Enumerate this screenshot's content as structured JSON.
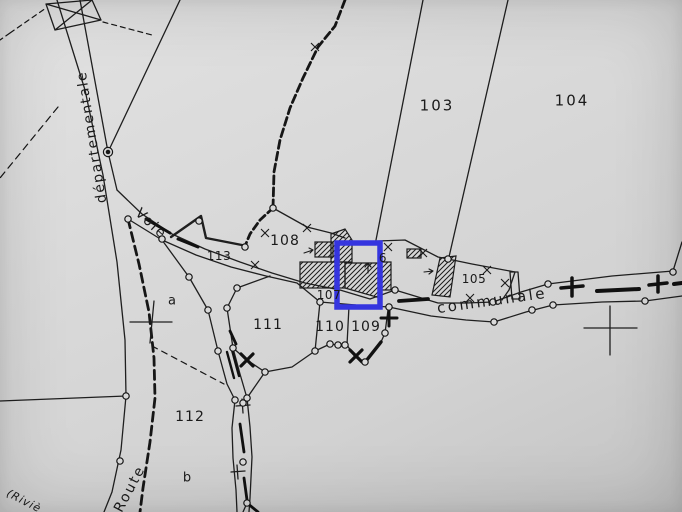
{
  "highlight": {
    "color": "#3535df"
  },
  "road_labels": {
    "departementale": "départementale",
    "voie": "Voie",
    "communale": "communale",
    "route": "Route",
    "riviere": "(Riviè"
  },
  "parcel_labels": {
    "p103": "103",
    "p104": "104",
    "p105": "105",
    "p106_partial": "6",
    "p107": "107",
    "p108": "108",
    "p109": "109",
    "p110": "110",
    "p111": "111",
    "p112": "112",
    "p113": "113"
  },
  "subdivision_labels": {
    "a": "a",
    "b": "b"
  }
}
